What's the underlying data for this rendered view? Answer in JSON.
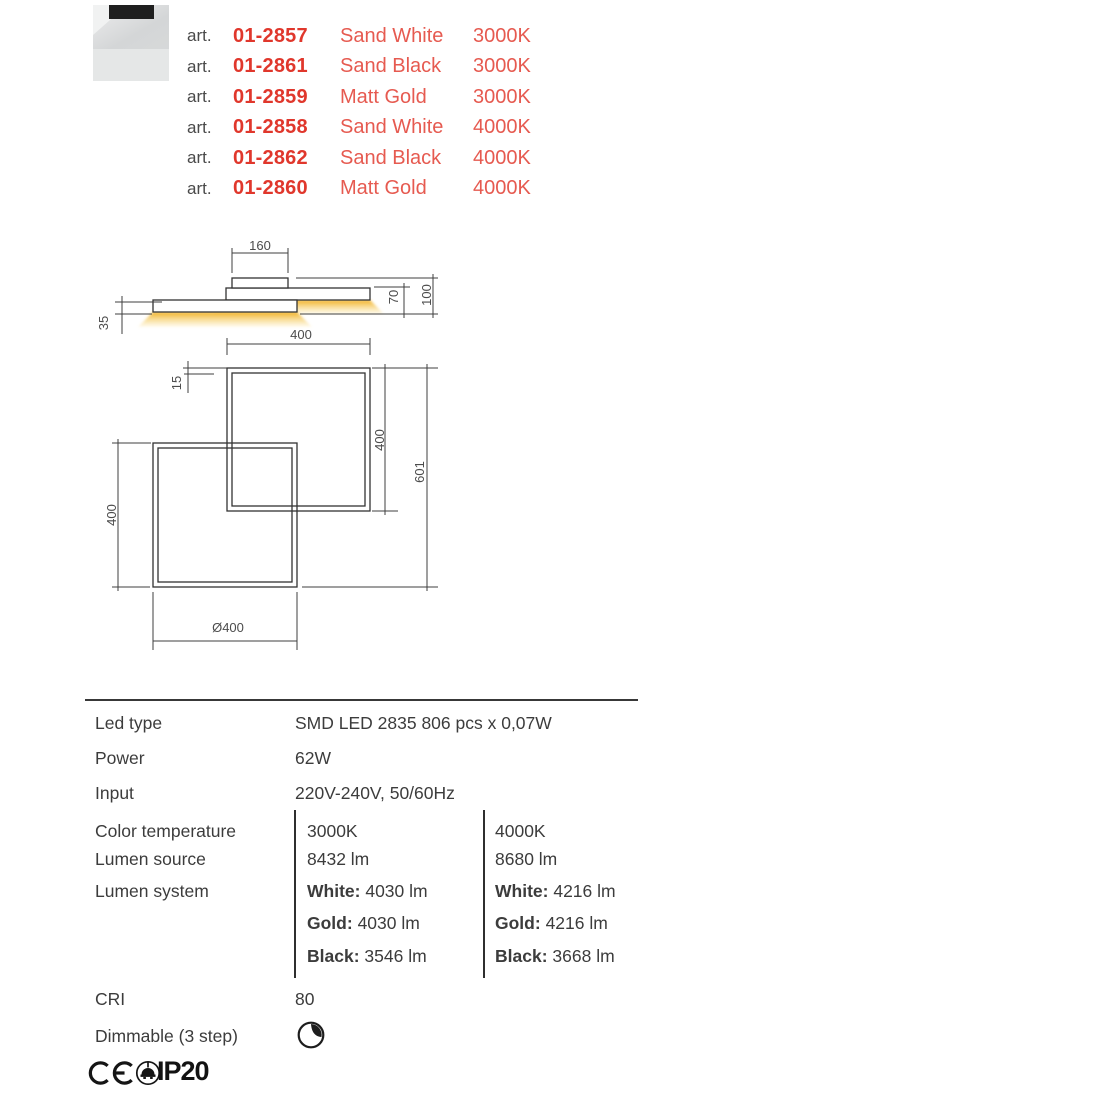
{
  "articles": [
    {
      "prefix": "art.",
      "code": "01-2857",
      "finish": "Sand White",
      "temp": "3000K"
    },
    {
      "prefix": "art.",
      "code": "01-2861",
      "finish": "Sand Black",
      "temp": "3000K"
    },
    {
      "prefix": "art.",
      "code": "01-2859",
      "finish": "Matt Gold",
      "temp": "3000K"
    },
    {
      "prefix": "art.",
      "code": "01-2858",
      "finish": "Sand White",
      "temp": "4000K"
    },
    {
      "prefix": "art.",
      "code": "01-2862",
      "finish": "Sand Black",
      "temp": "4000K"
    },
    {
      "prefix": "art.",
      "code": "01-2860",
      "finish": "Matt Gold",
      "temp": "4000K"
    }
  ],
  "drawing": {
    "dim_canopy": "160",
    "dim_35": "35",
    "dim_70": "70",
    "dim_100": "100",
    "dim_top_400": "400",
    "dim_15": "15",
    "dim_right_400": "400",
    "dim_601": "601",
    "dim_left_400": "400",
    "dim_diameter": "Ø400"
  },
  "specs": {
    "led_type": {
      "label": "Led type",
      "value": "SMD LED 2835 806 pcs x 0,07W"
    },
    "power": {
      "label": "Power",
      "value": "62W"
    },
    "input": {
      "label": "Input",
      "value": "220V-240V, 50/60Hz"
    },
    "color_temperature": {
      "label": "Color temperature",
      "warm": "3000K",
      "cold": "4000K"
    },
    "lumen_source": {
      "label": "Lumen source",
      "warm": "8432 lm",
      "cold": "8680 lm"
    },
    "lumen_system": {
      "label": "Lumen system",
      "warm": [
        {
          "finish": "White:",
          "value": "4030 lm"
        },
        {
          "finish": "Gold:",
          "value": "4030 lm"
        },
        {
          "finish": "Black:",
          "value": "3546 lm"
        }
      ],
      "cold": [
        {
          "finish": "White:",
          "value": "4216 lm"
        },
        {
          "finish": "Gold:",
          "value": "4216 lm"
        },
        {
          "finish": "Black:",
          "value": "3668 lm"
        }
      ]
    },
    "cri": {
      "label": "CRI",
      "value": "80"
    },
    "dimmable": {
      "label": "Dimmable (3 step)"
    }
  },
  "certifications": {
    "ip_rating": "IP20"
  },
  "colors": {
    "accent_red": "#e0372c",
    "finish_red": "#e65a50",
    "glow_gold": "#f0ab16",
    "line": "#3b3b3b",
    "text": "#3e3e3e"
  }
}
